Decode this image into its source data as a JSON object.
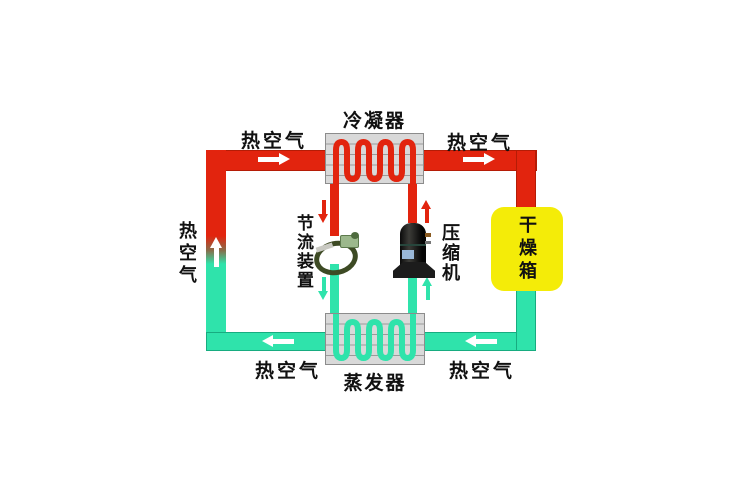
{
  "diagram": {
    "condenser": {
      "label": "冷凝器"
    },
    "evaporator": {
      "label": "蒸发器"
    },
    "throttle": {
      "label": "节流装置"
    },
    "compressor": {
      "label": "压缩机"
    },
    "drying_box": {
      "label": "干燥箱"
    },
    "air_flow": {
      "top_left_label": "热空气",
      "top_right_label": "热空气",
      "bottom_left_label": "热空气",
      "bottom_right_label": "热空气",
      "left_label": "热空气"
    },
    "colors": {
      "hot_air": "#e2240e",
      "cold_air": "#2fe3ab",
      "drying_box_fill": "#f4ec08",
      "heat_exchanger_fill": "#d9d9d9"
    },
    "icons": {
      "airflow_arrow_right": "▶",
      "airflow_arrow_left": "◀",
      "airflow_arrow_up": "▲",
      "refrigerant_arrow_down": "▼",
      "refrigerant_arrow_up": "▲"
    }
  }
}
